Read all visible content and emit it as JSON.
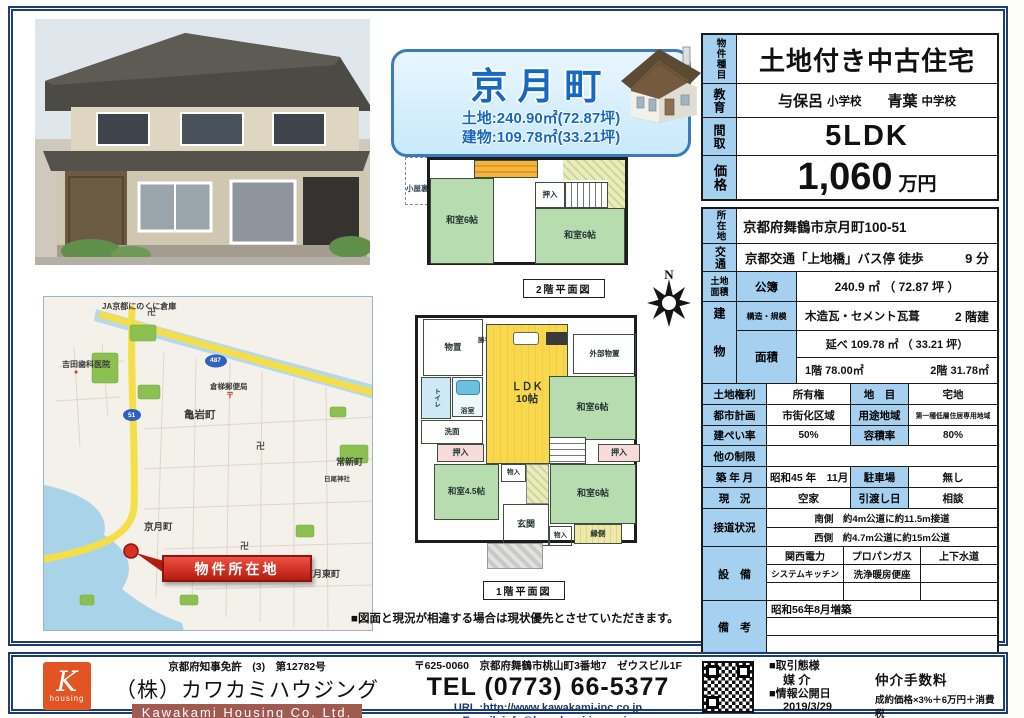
{
  "banner": {
    "title": "京月町",
    "land": "土地:240.90㎡(72.87坪)",
    "building": "建物:109.78㎡(33.21坪)"
  },
  "spec": {
    "type_label": "物件種目",
    "type_value": "土地付き中古住宅",
    "edu_label": "教育",
    "edu_elementary": "与保呂",
    "edu_elementary_suffix": "小学校",
    "edu_junior": "青葉",
    "edu_junior_suffix": "中学校",
    "layout_label": "間取",
    "layout_value": "5LDK",
    "price_label": "価格",
    "price_value": "1,060",
    "price_unit": "万円",
    "address_label": "所在地",
    "address_value": "京都府舞鶴市京月町100-51",
    "access_label": "交通",
    "access_value": "京都交通「上地橋」バス停 徒歩",
    "access_minutes": "9 分",
    "land_area_label": "土地面積",
    "land_area_sub": "公簿",
    "land_area_value": "240.9 ㎡ （ 72.87 坪 ）",
    "building_label": "建物",
    "structure_label": "構造・規模",
    "structure_value": "木造瓦・セメント瓦葺",
    "structure_floors": "2 階建",
    "area_label": "面積",
    "area_total": "延べ 109.78 ㎡ （ 33.21 坪）",
    "area_floor1": "1階 78.00㎡",
    "area_floor2": "2階 31.78㎡",
    "land_right_label": "土地権利",
    "land_right_value": "所有権",
    "land_use_label": "地　目",
    "land_use_value": "宅地",
    "city_plan_label": "都市計画",
    "city_plan_value": "市街化区域",
    "zone_label": "用途地域",
    "zone_value": "第一種低層住居専用地域",
    "bcr_label": "建ぺい率",
    "bcr_value": "50%",
    "far_label": "容積率",
    "far_value": "80%",
    "other_limit_label": "他の制限",
    "other_limit_value": "",
    "built_label": "築 年 月",
    "built_value": "昭和45 年　11月",
    "parking_label": "駐車場",
    "parking_value": "無し",
    "status_label": "現　況",
    "status_value": "空家",
    "handover_label": "引渡し日",
    "handover_value": "相談",
    "road_label": "接道状況",
    "road_line1": "南側　約4m公道に約11.5m接道",
    "road_line2": "西側　約4.7m公道に約15m公道",
    "facility_label": "設　備",
    "facility_cells": [
      "関西電力",
      "プロパンガス",
      "上下水道",
      "システムキッチン",
      "洗浄暖房便座",
      "",
      "",
      "",
      ""
    ],
    "remarks_label": "備　考",
    "remarks_value": "昭和56年8月増築"
  },
  "plans": {
    "f2_caption": "2階平面図",
    "f2_attic": "小屋裏収納",
    "f2_washitsu_left": "和室6帖",
    "f2_washitsu_right": "和室6帖",
    "f2_oshiire": "押入",
    "f1_caption": "1階平面図",
    "f1_monooki": "物置",
    "f1_katteguchi": "勝手口",
    "f1_ldk": "ＬＤＫ\n10帖",
    "f1_outer_storage": "外部物置",
    "f1_washitsu6_upper": "和室6帖",
    "f1_toilet": "トイレ",
    "f1_bath": "浴室",
    "f1_senmen": "洗面",
    "f1_oshiire_left": "押入",
    "f1_oshiire_right": "押入",
    "f1_washitsu45": "和室4.5帖",
    "f1_monoire_center": "物入",
    "f1_genkan": "玄関",
    "f1_monoire_right": "物入",
    "f1_washitsu6_lower": "和室6帖",
    "f1_engawa": "縁側",
    "note": "■図面と現況が相違する場合は現状優先とさせていただきます。",
    "compass": "N"
  },
  "map": {
    "label_ja": "JA京都にのくに倉庫",
    "label_dental": "吉田歯科医院",
    "label_post": "倉梯郵便局",
    "label_kameiwa": "亀岩町",
    "label_tsunemachi": "常新町",
    "label_shrine": "日尾神社",
    "label_kyogetsu": "京月町",
    "label_kyogetsu_east": "京月東町",
    "marker": "物件所在地",
    "badge1": "487",
    "badge2": "51",
    "temple_mark": "卍",
    "post_mark": "〒"
  },
  "footer": {
    "license": "京都府知事免許　(3)　第12782号",
    "company_jp": "（株）カワカミハウジング",
    "company_en": "Kawakami Housing Co. Ltd.",
    "logo_letter": "K",
    "logo_sub": "housing",
    "address": "〒625-0060　京都府舞鶴市桃山町3番地7　ゼウスビル1F",
    "tel": "TEL (0773) 66-5377",
    "url": "URL :http://www.kawakami-inc.co.jp",
    "email": "E-mail :info@kawakami-inc.co.jp",
    "deal_label": "■取引態様",
    "deal_value": "媒 介",
    "publish_label": "■情報公開日",
    "publish_value": "2019/3/29",
    "fee_label": "仲介手数料",
    "fee_value": "成約価格×3%＋6万円＋消費税"
  }
}
